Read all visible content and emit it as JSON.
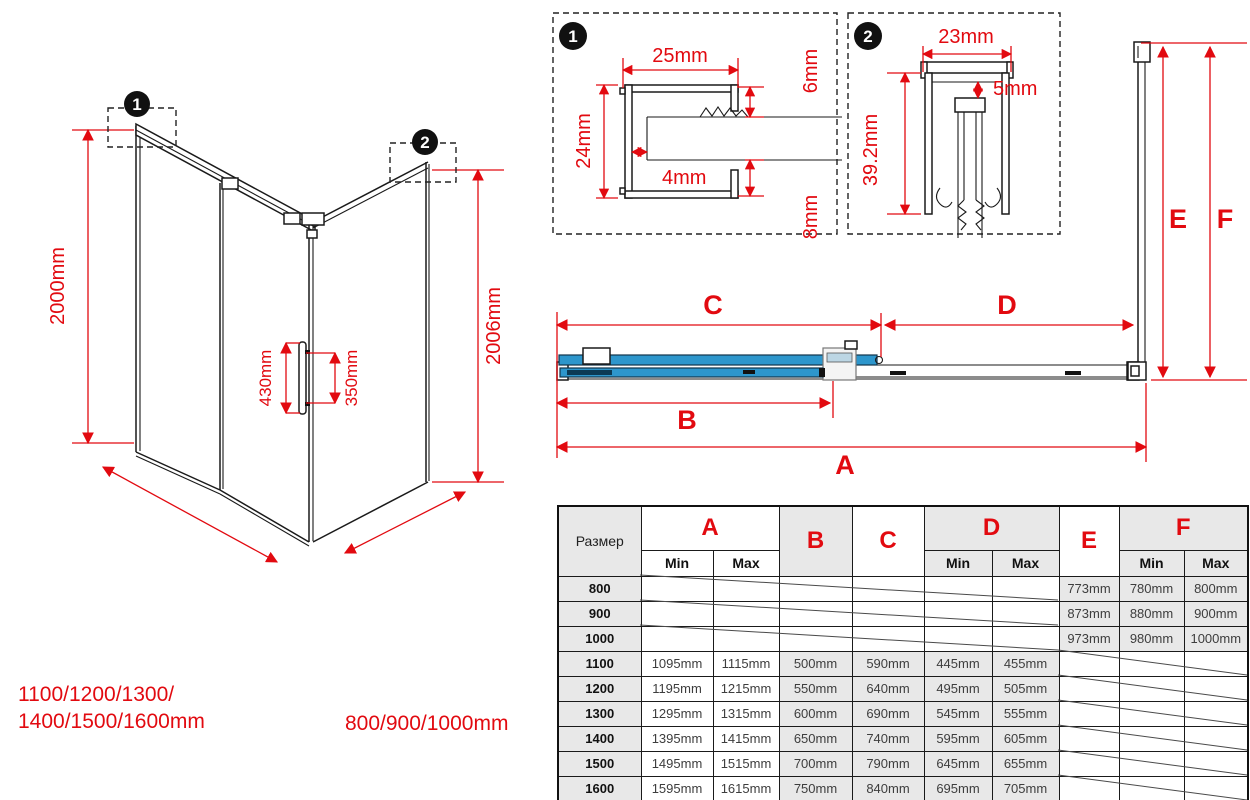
{
  "colors": {
    "red": "#e20a10",
    "blue": "#2d96cc",
    "table_gray": "#e8e8e8"
  },
  "callouts": {
    "one": "1",
    "two": "2"
  },
  "iso": {
    "height_left": "2000mm",
    "height_right": "2006mm",
    "handle_length": "430mm",
    "handle_holes": "350mm",
    "width_label_line1": "1100/1200/1300/",
    "width_label_line2": "1400/1500/1600mm",
    "depth_label": "800/900/1000mm"
  },
  "detail1": {
    "marker": "1",
    "profile_width": "25mm",
    "profile_height": "24mm",
    "slot_gap": "4mm",
    "top_lip": "6mm",
    "bottom_lip": "8mm"
  },
  "detail2": {
    "marker": "2",
    "profile_width": "23mm",
    "profile_height": "39.2mm",
    "inner_gap": "5mm"
  },
  "table": {
    "size_header": "Размер",
    "min_label": "Min",
    "max_label": "Max",
    "groups": [
      "A",
      "B",
      "C",
      "D",
      "E",
      "F"
    ],
    "rows": [
      {
        "size": "800",
        "cells": [
          "",
          "",
          "",
          "",
          "",
          "",
          "773mm",
          "780mm",
          "800mm"
        ],
        "struck": "abcd"
      },
      {
        "size": "900",
        "cells": [
          "",
          "",
          "",
          "",
          "",
          "",
          "873mm",
          "880mm",
          "900mm"
        ],
        "struck": "abcd"
      },
      {
        "size": "1000",
        "cells": [
          "",
          "",
          "",
          "",
          "",
          "",
          "973mm",
          "980mm",
          "1000mm"
        ],
        "struck": "abcd"
      },
      {
        "size": "1100",
        "cells": [
          "1095mm",
          "1115mm",
          "500mm",
          "590mm",
          "445mm",
          "455mm",
          "",
          "",
          ""
        ],
        "struck": "ef"
      },
      {
        "size": "1200",
        "cells": [
          "1195mm",
          "1215mm",
          "550mm",
          "640mm",
          "495mm",
          "505mm",
          "",
          "",
          ""
        ],
        "struck": "ef"
      },
      {
        "size": "1300",
        "cells": [
          "1295mm",
          "1315mm",
          "600mm",
          "690mm",
          "545mm",
          "555mm",
          "",
          "",
          ""
        ],
        "struck": "ef"
      },
      {
        "size": "1400",
        "cells": [
          "1395mm",
          "1415mm",
          "650mm",
          "740mm",
          "595mm",
          "605mm",
          "",
          "",
          ""
        ],
        "struck": "ef"
      },
      {
        "size": "1500",
        "cells": [
          "1495mm",
          "1515mm",
          "700mm",
          "790mm",
          "645mm",
          "655mm",
          "",
          "",
          ""
        ],
        "struck": "ef"
      },
      {
        "size": "1600",
        "cells": [
          "1595mm",
          "1615mm",
          "750mm",
          "840mm",
          "695mm",
          "705mm",
          "",
          "",
          ""
        ],
        "struck": "ef"
      }
    ]
  }
}
